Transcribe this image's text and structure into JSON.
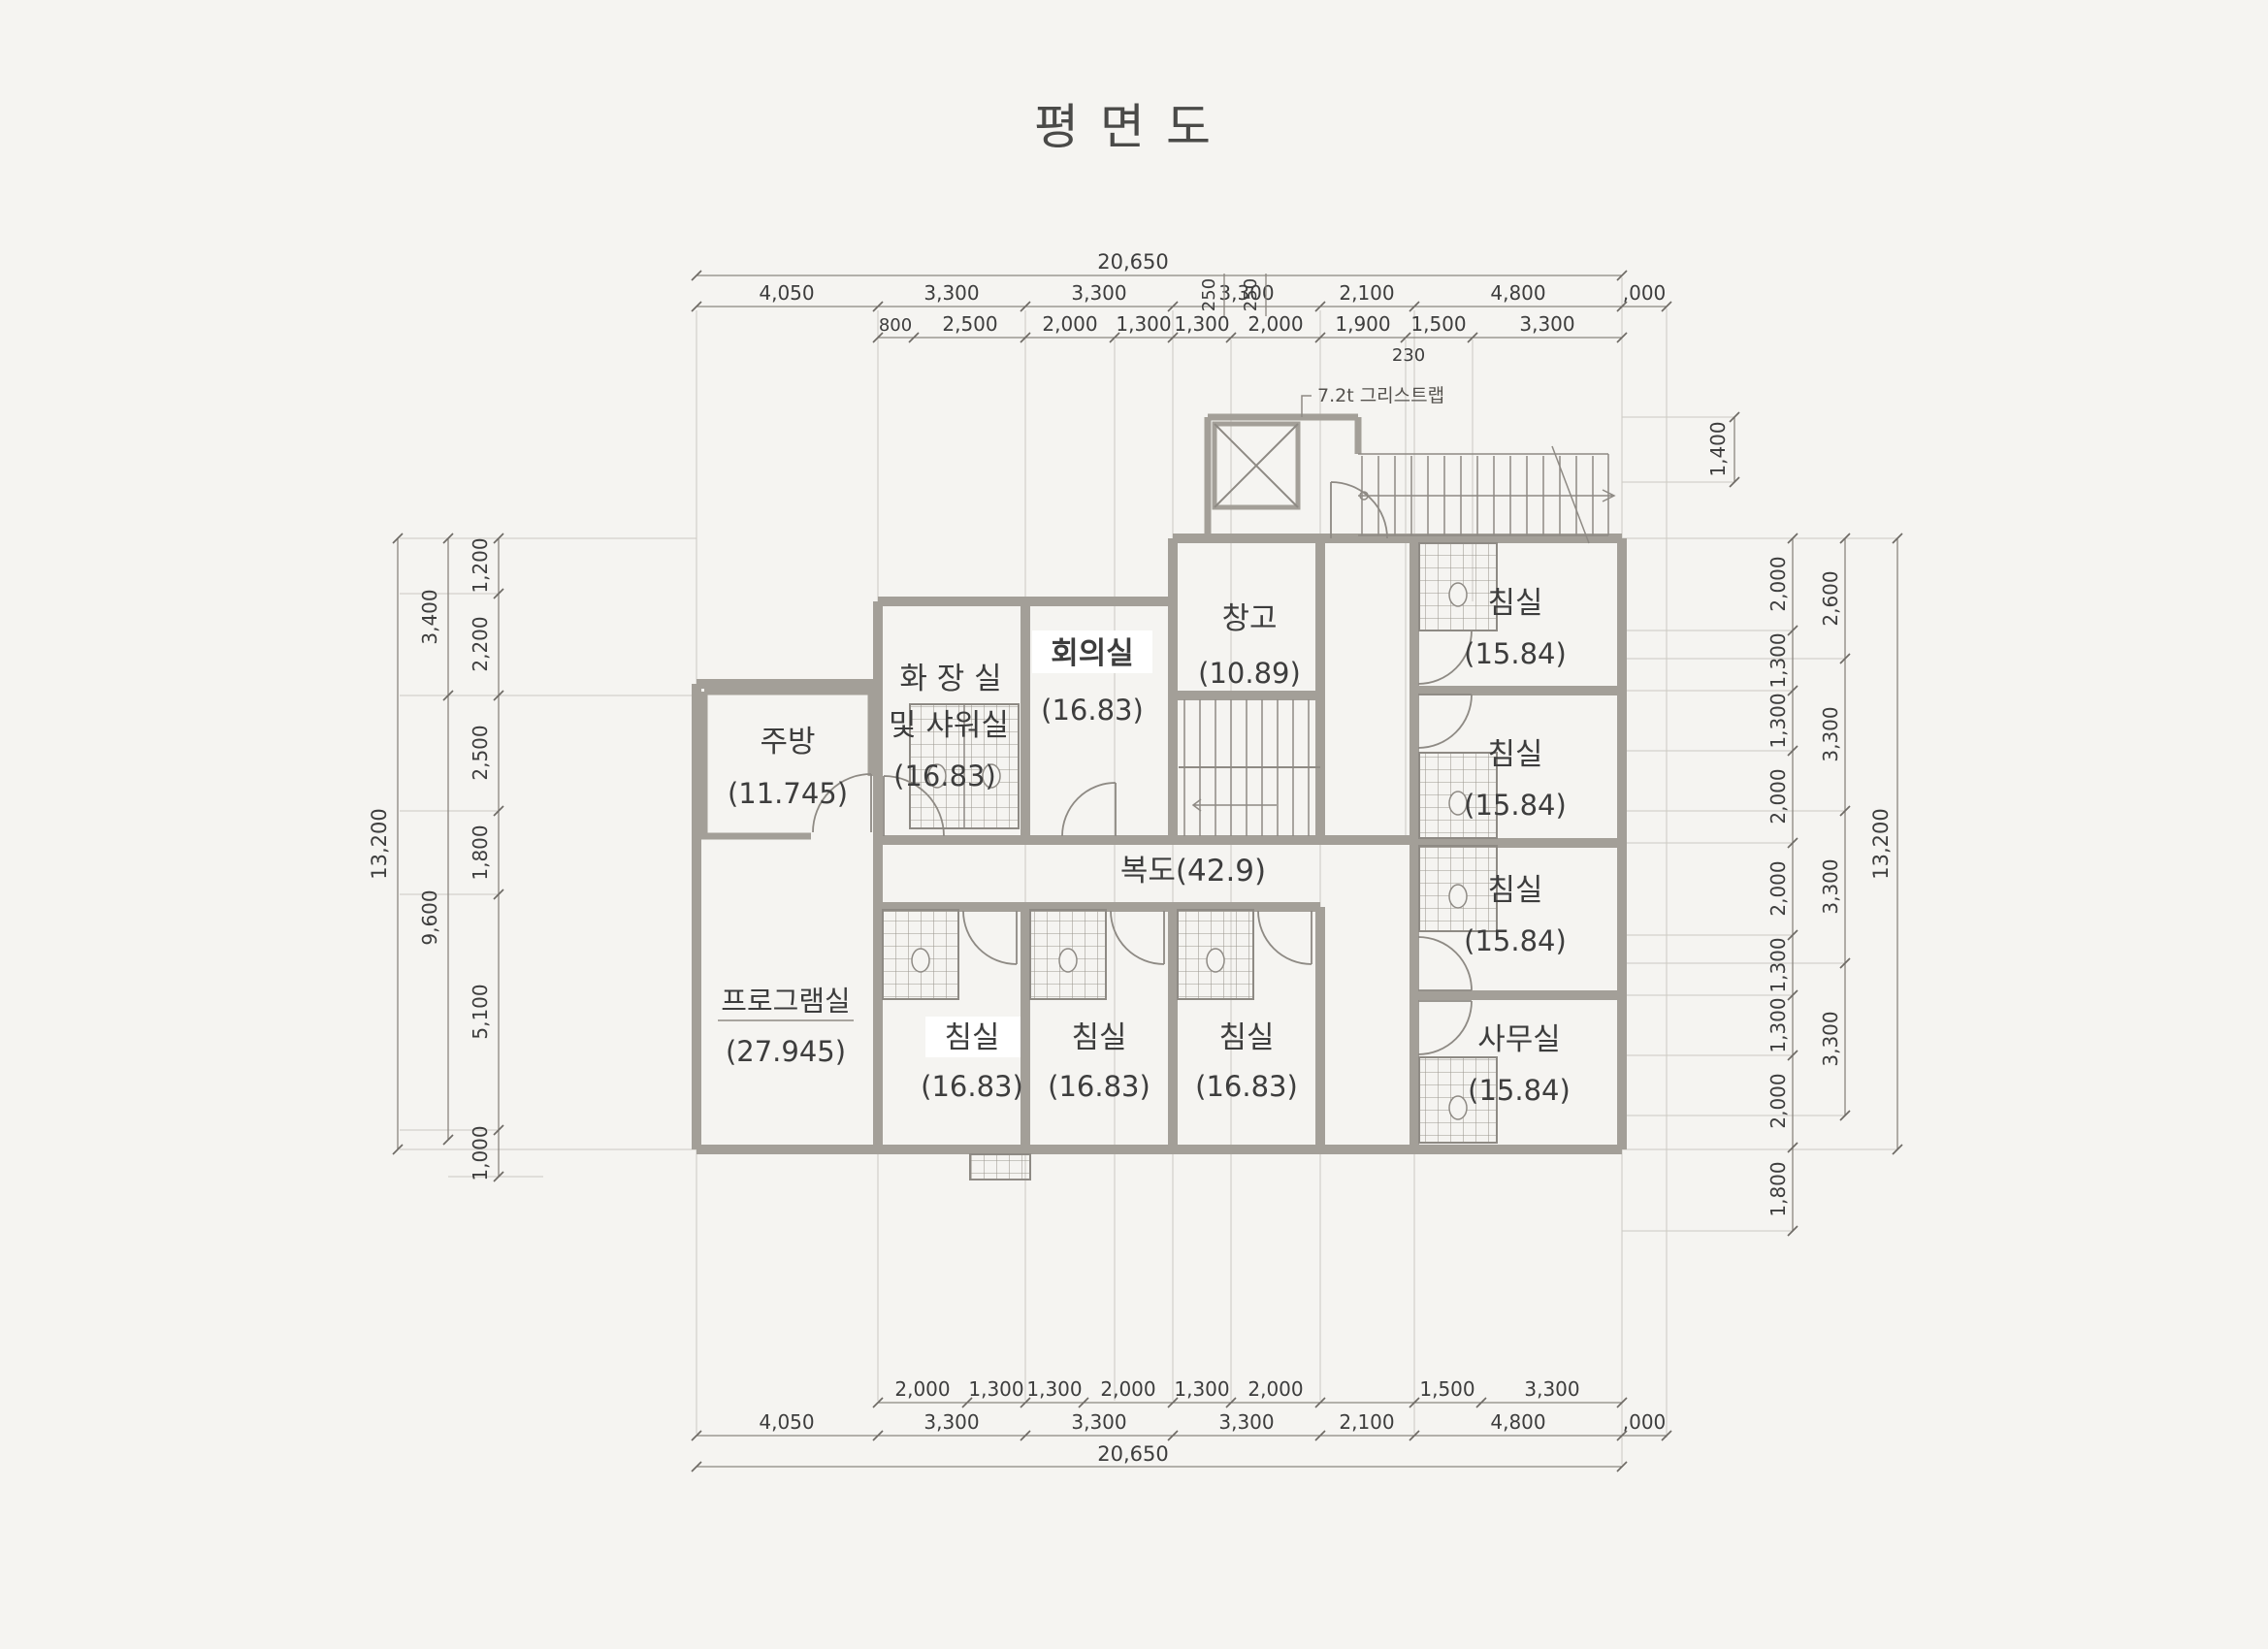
{
  "title": "평면도",
  "annotation": "7.2t 그리스트랩",
  "rooms": {
    "kitchen": {
      "name": "주방",
      "area": "(11.745)"
    },
    "toilet": {
      "name1": "화 장 실",
      "name2": "및 샤워실",
      "area": "(16.83)"
    },
    "meeting": {
      "name": "회의실",
      "area": "(16.83)"
    },
    "storage": {
      "name": "창고",
      "area": "(10.89)"
    },
    "bed_tr": {
      "name": "침실",
      "area": "(15.84)"
    },
    "bed_r2": {
      "name": "침실",
      "area": "(15.84)"
    },
    "bed_r3": {
      "name": "침실",
      "area": "(15.84)"
    },
    "office": {
      "name": "사무실",
      "area": "(15.84)"
    },
    "corridor": {
      "name": "복도(42.9)"
    },
    "program": {
      "name": "프로그램실",
      "area": "(27.945)"
    },
    "bed_b1": {
      "name": "침실",
      "area": "(16.83)"
    },
    "bed_b2": {
      "name": "침실",
      "area": "(16.83)"
    },
    "bed_b3": {
      "name": "침실",
      "area": "(16.83)"
    }
  },
  "dims": {
    "top": {
      "overall": "20,650",
      "row_a": [
        "4,050",
        "3,300",
        "3,300",
        "3,300",
        "2,100",
        "4,800",
        ",000"
      ],
      "row_b": [
        "800",
        "2,500",
        "2,000",
        "1,300",
        "1,300",
        "2,000",
        "1,900",
        "1,500",
        "3,300"
      ],
      "offset": "230"
    },
    "bottom": {
      "overall": "20,650",
      "row_a": [
        "4,050",
        "3,300",
        "3,300",
        "3,300",
        "2,100",
        "4,800",
        ",000"
      ],
      "row_b": [
        "2,000",
        "1,300",
        "1,300",
        "2,000",
        "1,300",
        "2,000",
        "1,500",
        "3,300"
      ]
    },
    "left": {
      "overall": "13,200",
      "mid": [
        "3,400",
        "9,600"
      ],
      "inner": [
        "1,200",
        "2,200",
        "2,500",
        "1,800",
        "5,100",
        "1,000"
      ]
    },
    "right": {
      "overall": "13,200",
      "mid": [
        "2,600",
        "3,300",
        "3,300",
        "3,300"
      ],
      "inner": [
        "2,000",
        "1,300",
        "1,300",
        "2,000",
        "2,000",
        "1,300",
        "1,300",
        "2,000",
        "1,800"
      ],
      "stair": "1,400",
      "small": [
        "250",
        "250"
      ]
    }
  },
  "colors": {
    "paper": "#f5f4f1",
    "wall": "#a39f98",
    "line": "#8a867f",
    "light": "#ccc9c3",
    "text": "#3d3d3d"
  }
}
